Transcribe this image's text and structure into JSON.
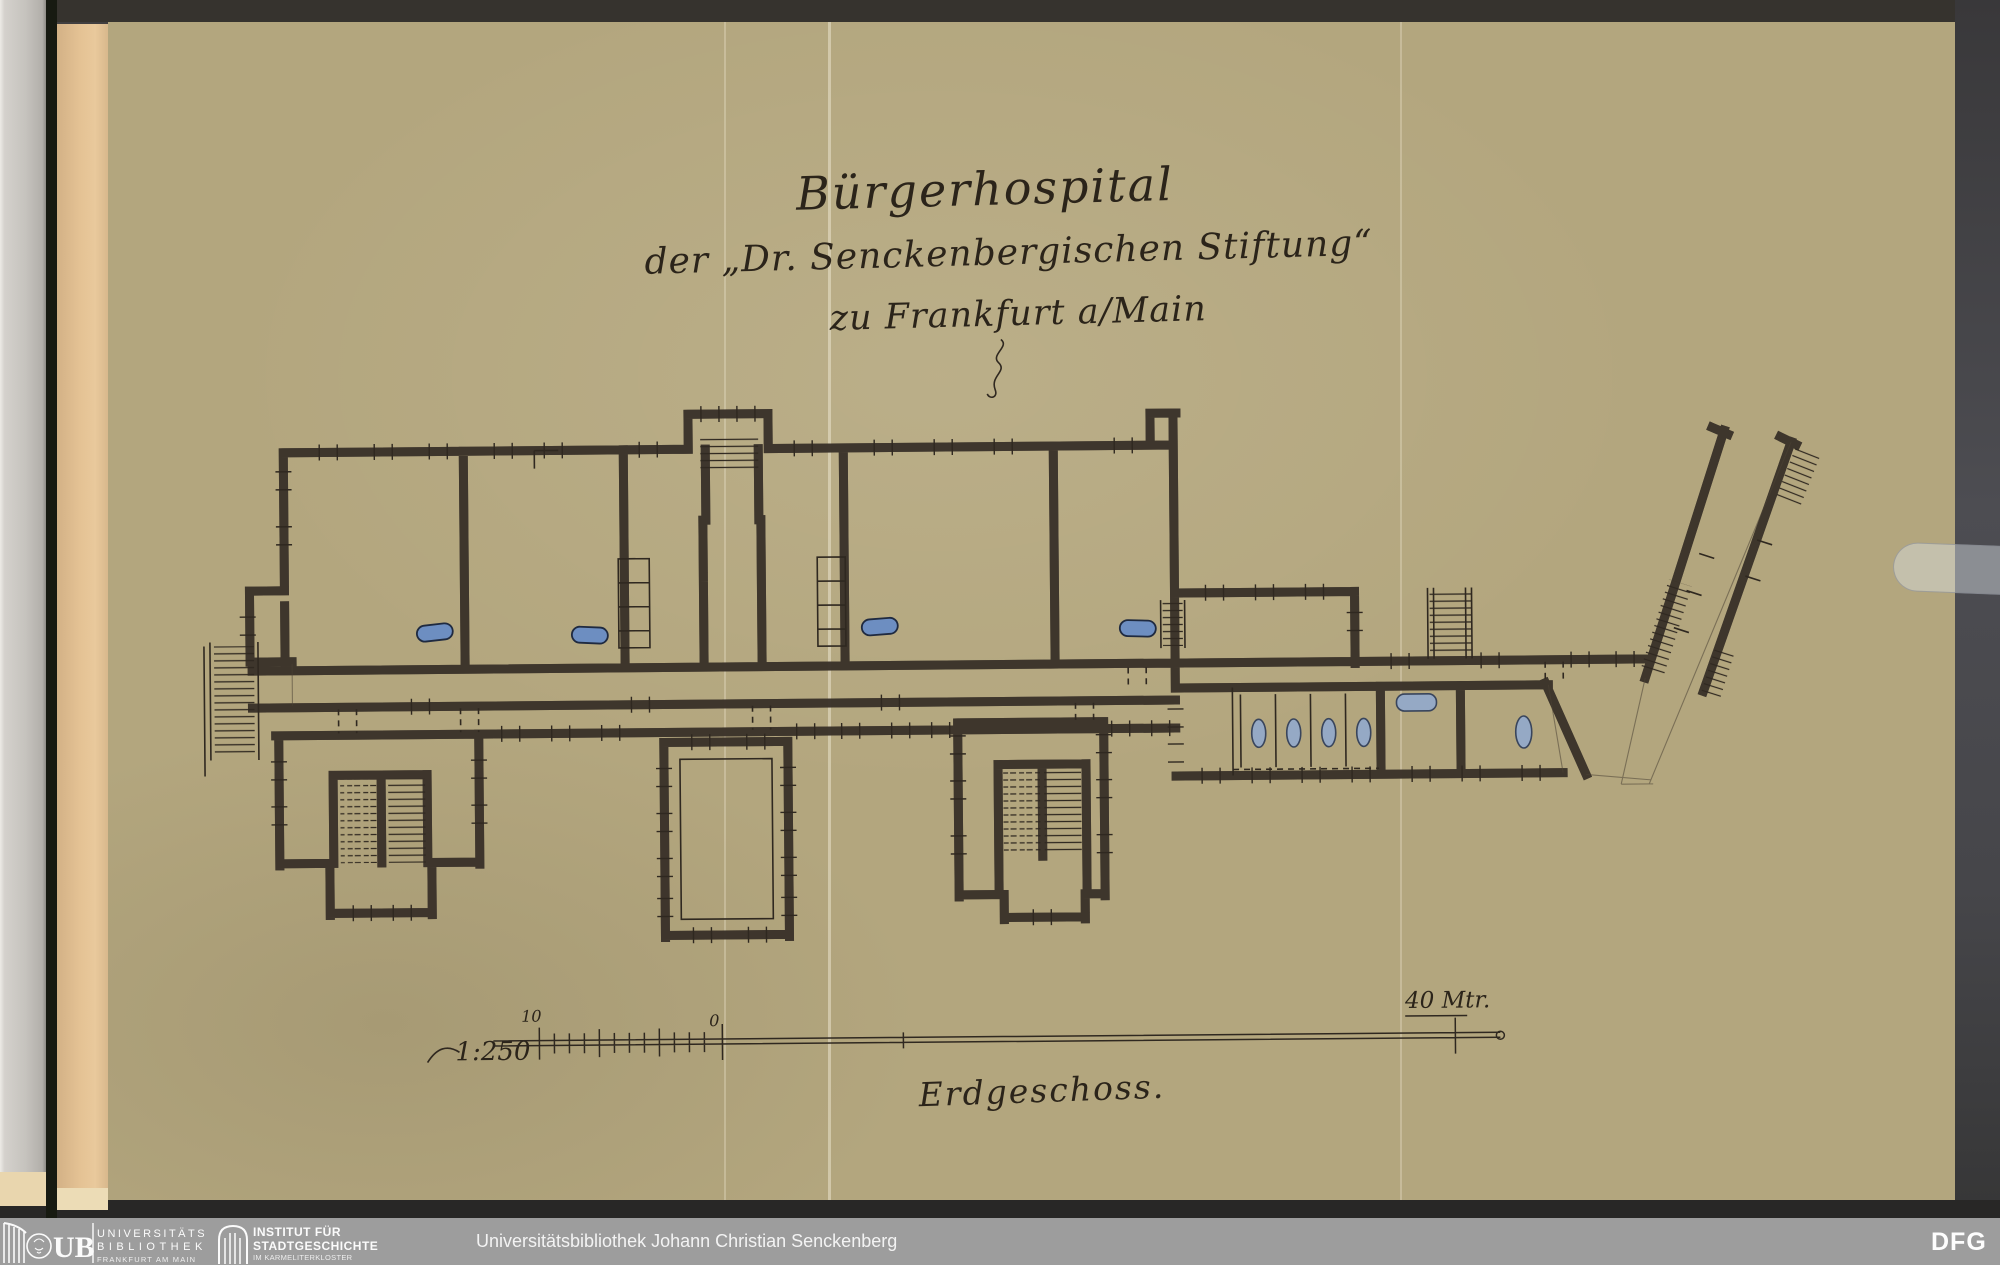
{
  "document": {
    "kind": "scanned architectural floor plan on brown tracing paper, bound volume",
    "title_line1": "Bürgerhospital",
    "title_line2": "der „Dr. Senckenbergischen Stiftung“",
    "title_line3": "zu Frankfurt a/Main",
    "floor_label": "Erdgeschoss.",
    "scale": {
      "ratio_label": "1:250",
      "tick_label_left": "10",
      "tick_label_zero": "0",
      "length_label": "40 Mtr."
    }
  },
  "footer": {
    "ub": {
      "logo": "ub-frankfurt-logo",
      "abbrev": "UB",
      "lines": [
        "UNIVERSITÄTS",
        "BIBLIOTHEK",
        "FRANKFURT AM MAIN"
      ]
    },
    "isg": {
      "logo": "institut-stadtgeschichte-logo",
      "lines": [
        "INSTITUT FÜR",
        "STADTGESCHICHTE",
        "IM KARMELITERKLOSTER",
        "FRANKFURT AM MAIN"
      ]
    },
    "library_credit": "Universitätsbibliothek Johann Christian Senckenberg",
    "dfg_label": "DFG"
  },
  "colors": {
    "paper": "#b3a67e",
    "ink": "#2f2820",
    "wall_wash": "#8d8170",
    "fixture_blue": "#6d8ec1",
    "footer_bar": "#9d9d9d",
    "scanner_background": "#3c3a3a",
    "binding_edge": "#e4c294"
  }
}
